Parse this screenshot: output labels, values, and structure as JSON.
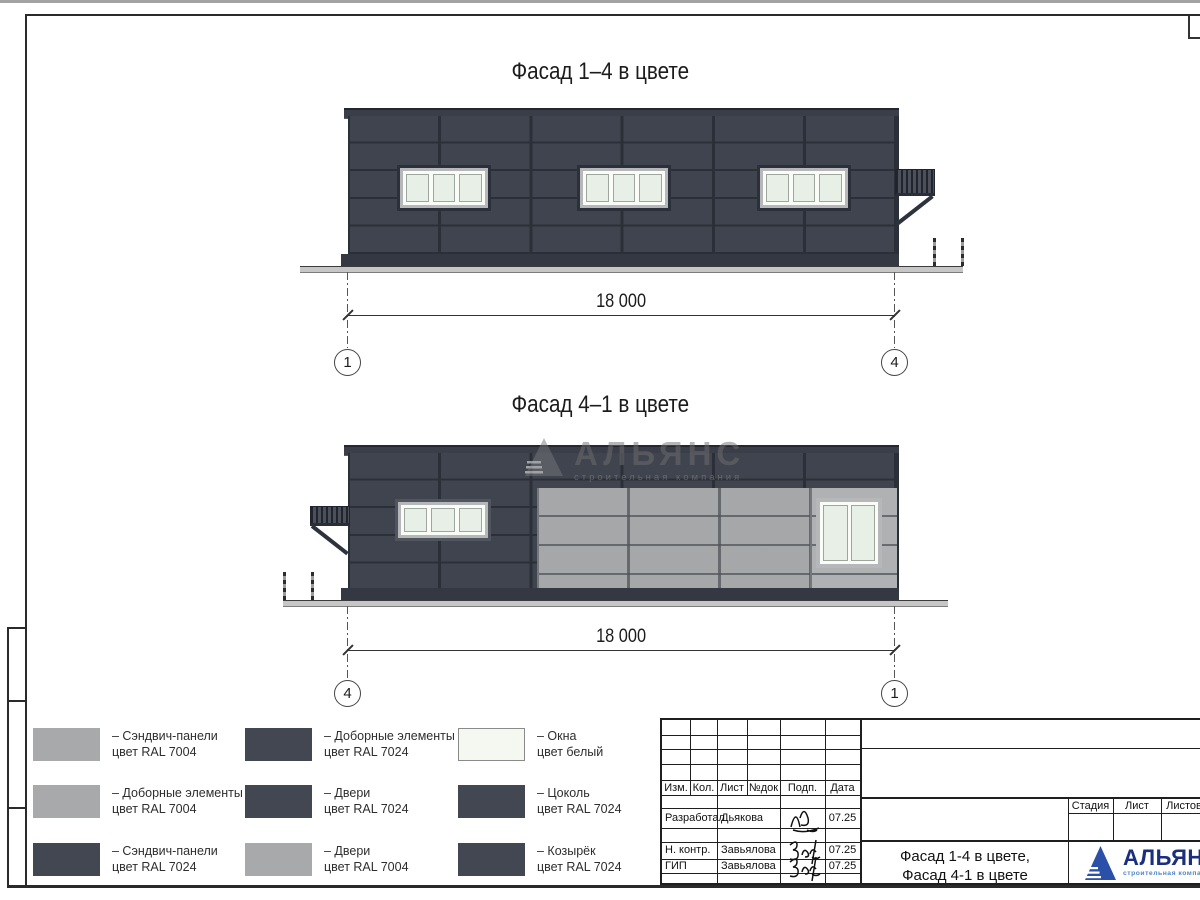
{
  "facade1": {
    "title": "Фасад 1–4 в цвете",
    "dimension": "18 000",
    "axis_left": "1",
    "axis_right": "4"
  },
  "facade2": {
    "title": "Фасад 4–1 в цвете",
    "dimension": "18 000",
    "axis_left": "4",
    "axis_right": "1"
  },
  "watermark": {
    "name": "АЛЬЯНС",
    "tagline": "строительная компания"
  },
  "legend": {
    "items": [
      {
        "color": "ral7004",
        "line1": "– Сэндвич-панели",
        "line2": "цвет RAL 7004"
      },
      {
        "color": "ral7024",
        "line1": "– Доборные элементы",
        "line2": "цвет RAL 7024"
      },
      {
        "color": "white",
        "line1": "– Окна",
        "line2": "цвет белый"
      },
      {
        "color": "ral7004",
        "line1": "– Доборные элементы",
        "line2": "цвет RAL 7004"
      },
      {
        "color": "ral7024",
        "line1": "– Двери",
        "line2": "цвет RAL 7024"
      },
      {
        "color": "ral7024",
        "line1": "– Цоколь",
        "line2": "цвет RAL 7024"
      },
      {
        "color": "ral7024",
        "line1": "– Сэндвич-панели",
        "line2": "цвет RAL 7024"
      },
      {
        "color": "ral7004",
        "line1": "– Двери",
        "line2": "цвет RAL 7004"
      },
      {
        "color": "ral7024",
        "line1": "– Козырёк",
        "line2": "цвет RAL 7024"
      }
    ]
  },
  "titleblock": {
    "header": [
      "Изм.",
      "Кол.",
      "Лист",
      "№док",
      "Подп.",
      "Дата"
    ],
    "rows": [
      {
        "role": "Разработал",
        "name": "Дьякова",
        "date": "07.25"
      },
      {
        "role": "Н. контр.",
        "name": "Завьялова",
        "date": "07.25"
      },
      {
        "role": "ГИП",
        "name": "Завьялова",
        "date": "07.25"
      }
    ],
    "stage_header": [
      "Стадия",
      "Лист",
      "Листов"
    ],
    "doc_title_line1": "Фасад 1-4 в цвете,",
    "doc_title_line2": "Фасад 4-1 в цвете"
  },
  "logo": {
    "name": "АЛЬЯНС",
    "tagline": "строительная компания"
  },
  "colors": {
    "ral7004": "#a8a9ab",
    "ral7024": "#434751",
    "white": "#f5f8f1",
    "panel_dark": "#3f444e",
    "panel_light": "#a5a7a9",
    "window_glass": "#e8efe6",
    "logo_blue": "#2b50a8",
    "logo_text": "#1c2e7e"
  }
}
